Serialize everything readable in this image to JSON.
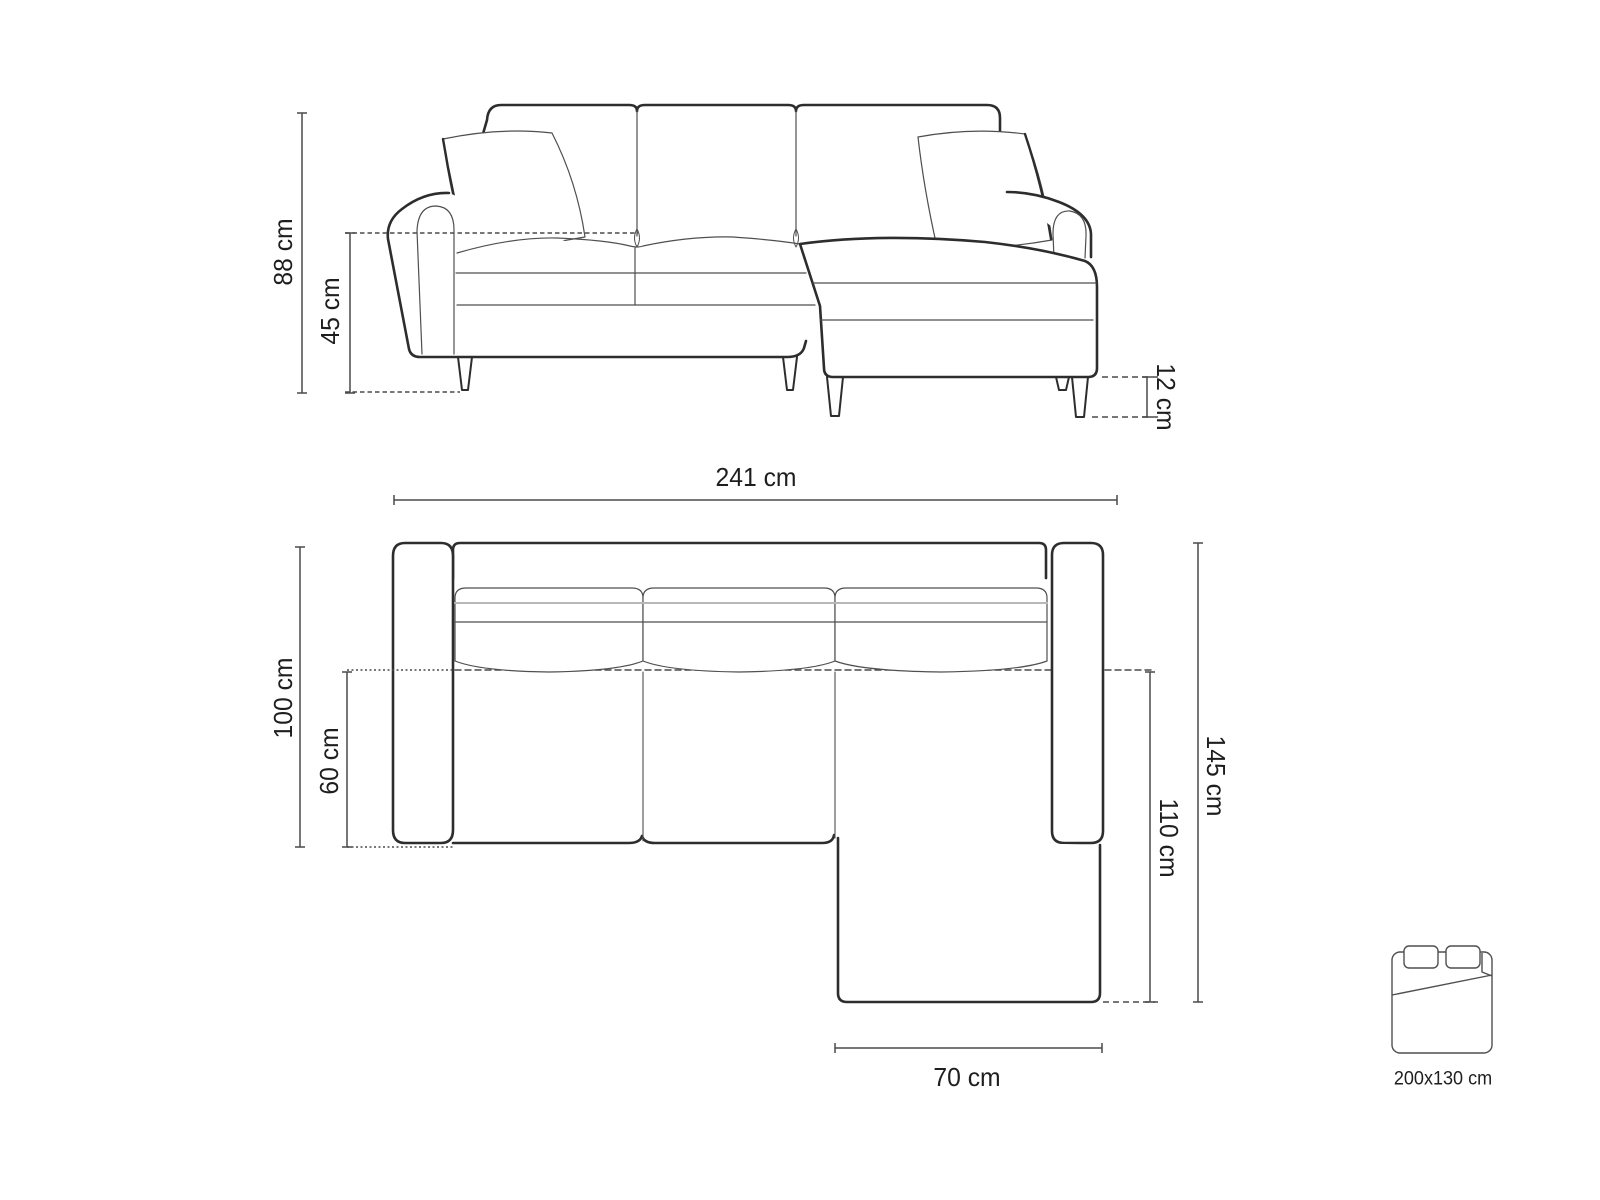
{
  "front_view": {
    "overall_height": "88 cm",
    "seat_height": "45 cm",
    "leg_height": "12 cm",
    "overall_width": "241 cm"
  },
  "top_view": {
    "side_depth": "100 cm",
    "seat_depth": "60 cm",
    "overall_depth": "145 cm",
    "chaise_length": "110 cm",
    "chaise_width": "70 cm"
  },
  "sleeping_area": {
    "icon": "sofa-bed-icon",
    "size": "200x130 cm"
  },
  "colors": {
    "background": "#ffffff",
    "outline_bold": "#2d2d2d",
    "outline_thin": "#4f4f4f",
    "line_light_gray": "#b8b8b8",
    "dimension_line": "#4a4a4a",
    "label_text": "#1e1e1e"
  }
}
